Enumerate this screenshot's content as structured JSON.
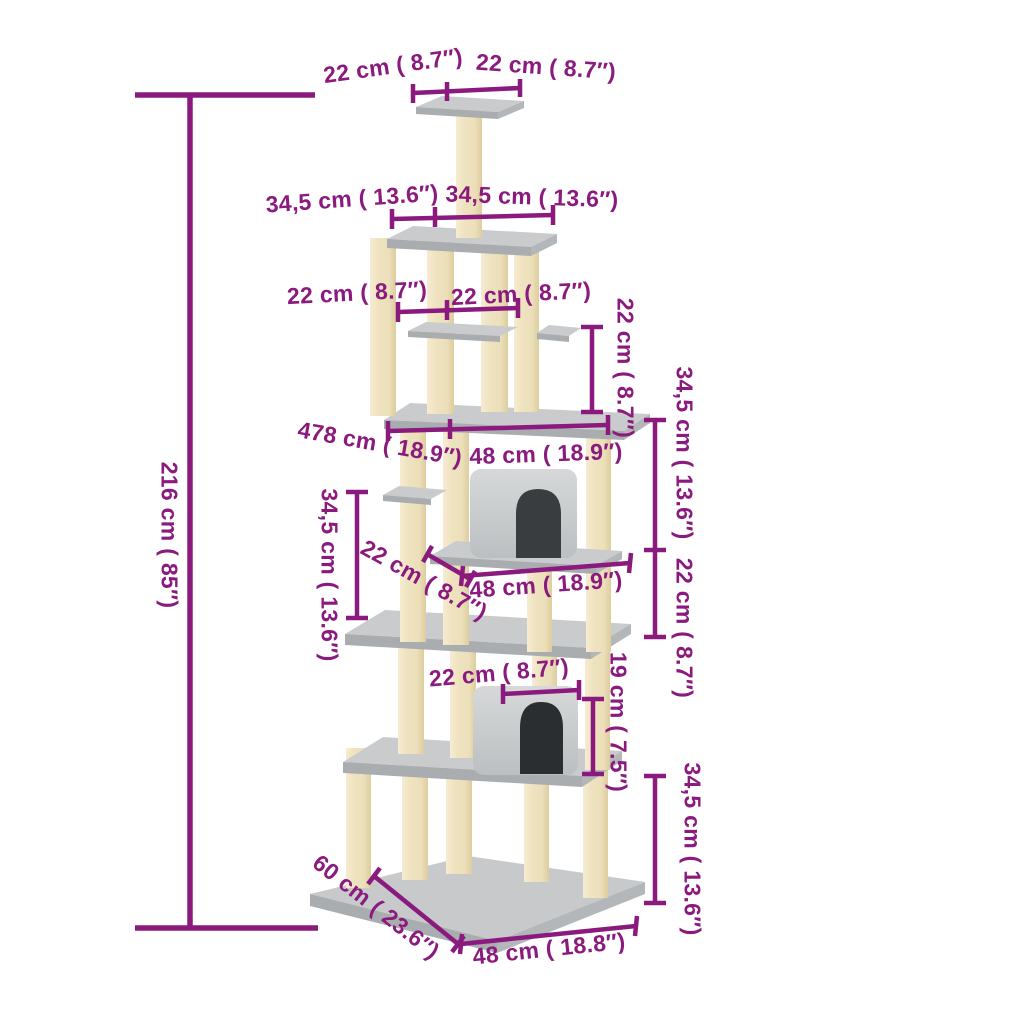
{
  "colors": {
    "annotation": "#8a1a7d",
    "platform_top": "#c9cbcd",
    "platform_edge": "#a9adaf",
    "post_light": "#f6ecd2",
    "post_mid": "#efe3c0",
    "post_dark": "#ddcd9e",
    "house_light": "#d6d8da",
    "house_mid": "#c2c5c7",
    "opening_upper": "#393d40",
    "opening_lower": "#2b2e30",
    "background": "#ffffff"
  },
  "measurements": {
    "total_height": "216 cm ( 85″)",
    "top_platform_depth": "22 cm ( 8.7″)",
    "top_platform_width": "22 cm ( 8.7″)",
    "second_platform_depth": "34,5 cm ( 13.6″)",
    "second_platform_width": "34,5 cm ( 13.6″)",
    "shelf_depth": "22 cm ( 8.7″)",
    "shelf_width": "22 cm ( 8.7″)",
    "shelf_drop_height": "22 cm ( 8.7″)",
    "main_platform_depth": "478 cm ( 18.9″)",
    "main_platform_width": "48 cm ( 18.9″)",
    "left_gap_height": "34,5 cm ( 13.6″)",
    "mid_platform_depth": "22 cm ( 8.7″)",
    "mid_platform_width": "48 cm ( 18.9″)",
    "right_gap_upper_height": "34,5 cm ( 13.6″)",
    "right_gap_lower_height": "22 cm ( 8.7″)",
    "lower_house_width": "22 cm ( 8.7″)",
    "lower_house_height": "19 cm ( 7.5″)",
    "base_gap_height": "34,5 cm ( 13.6″)",
    "base_depth": "60 cm ( 23.6″)",
    "base_width": "48 cm ( 18.8″)"
  }
}
